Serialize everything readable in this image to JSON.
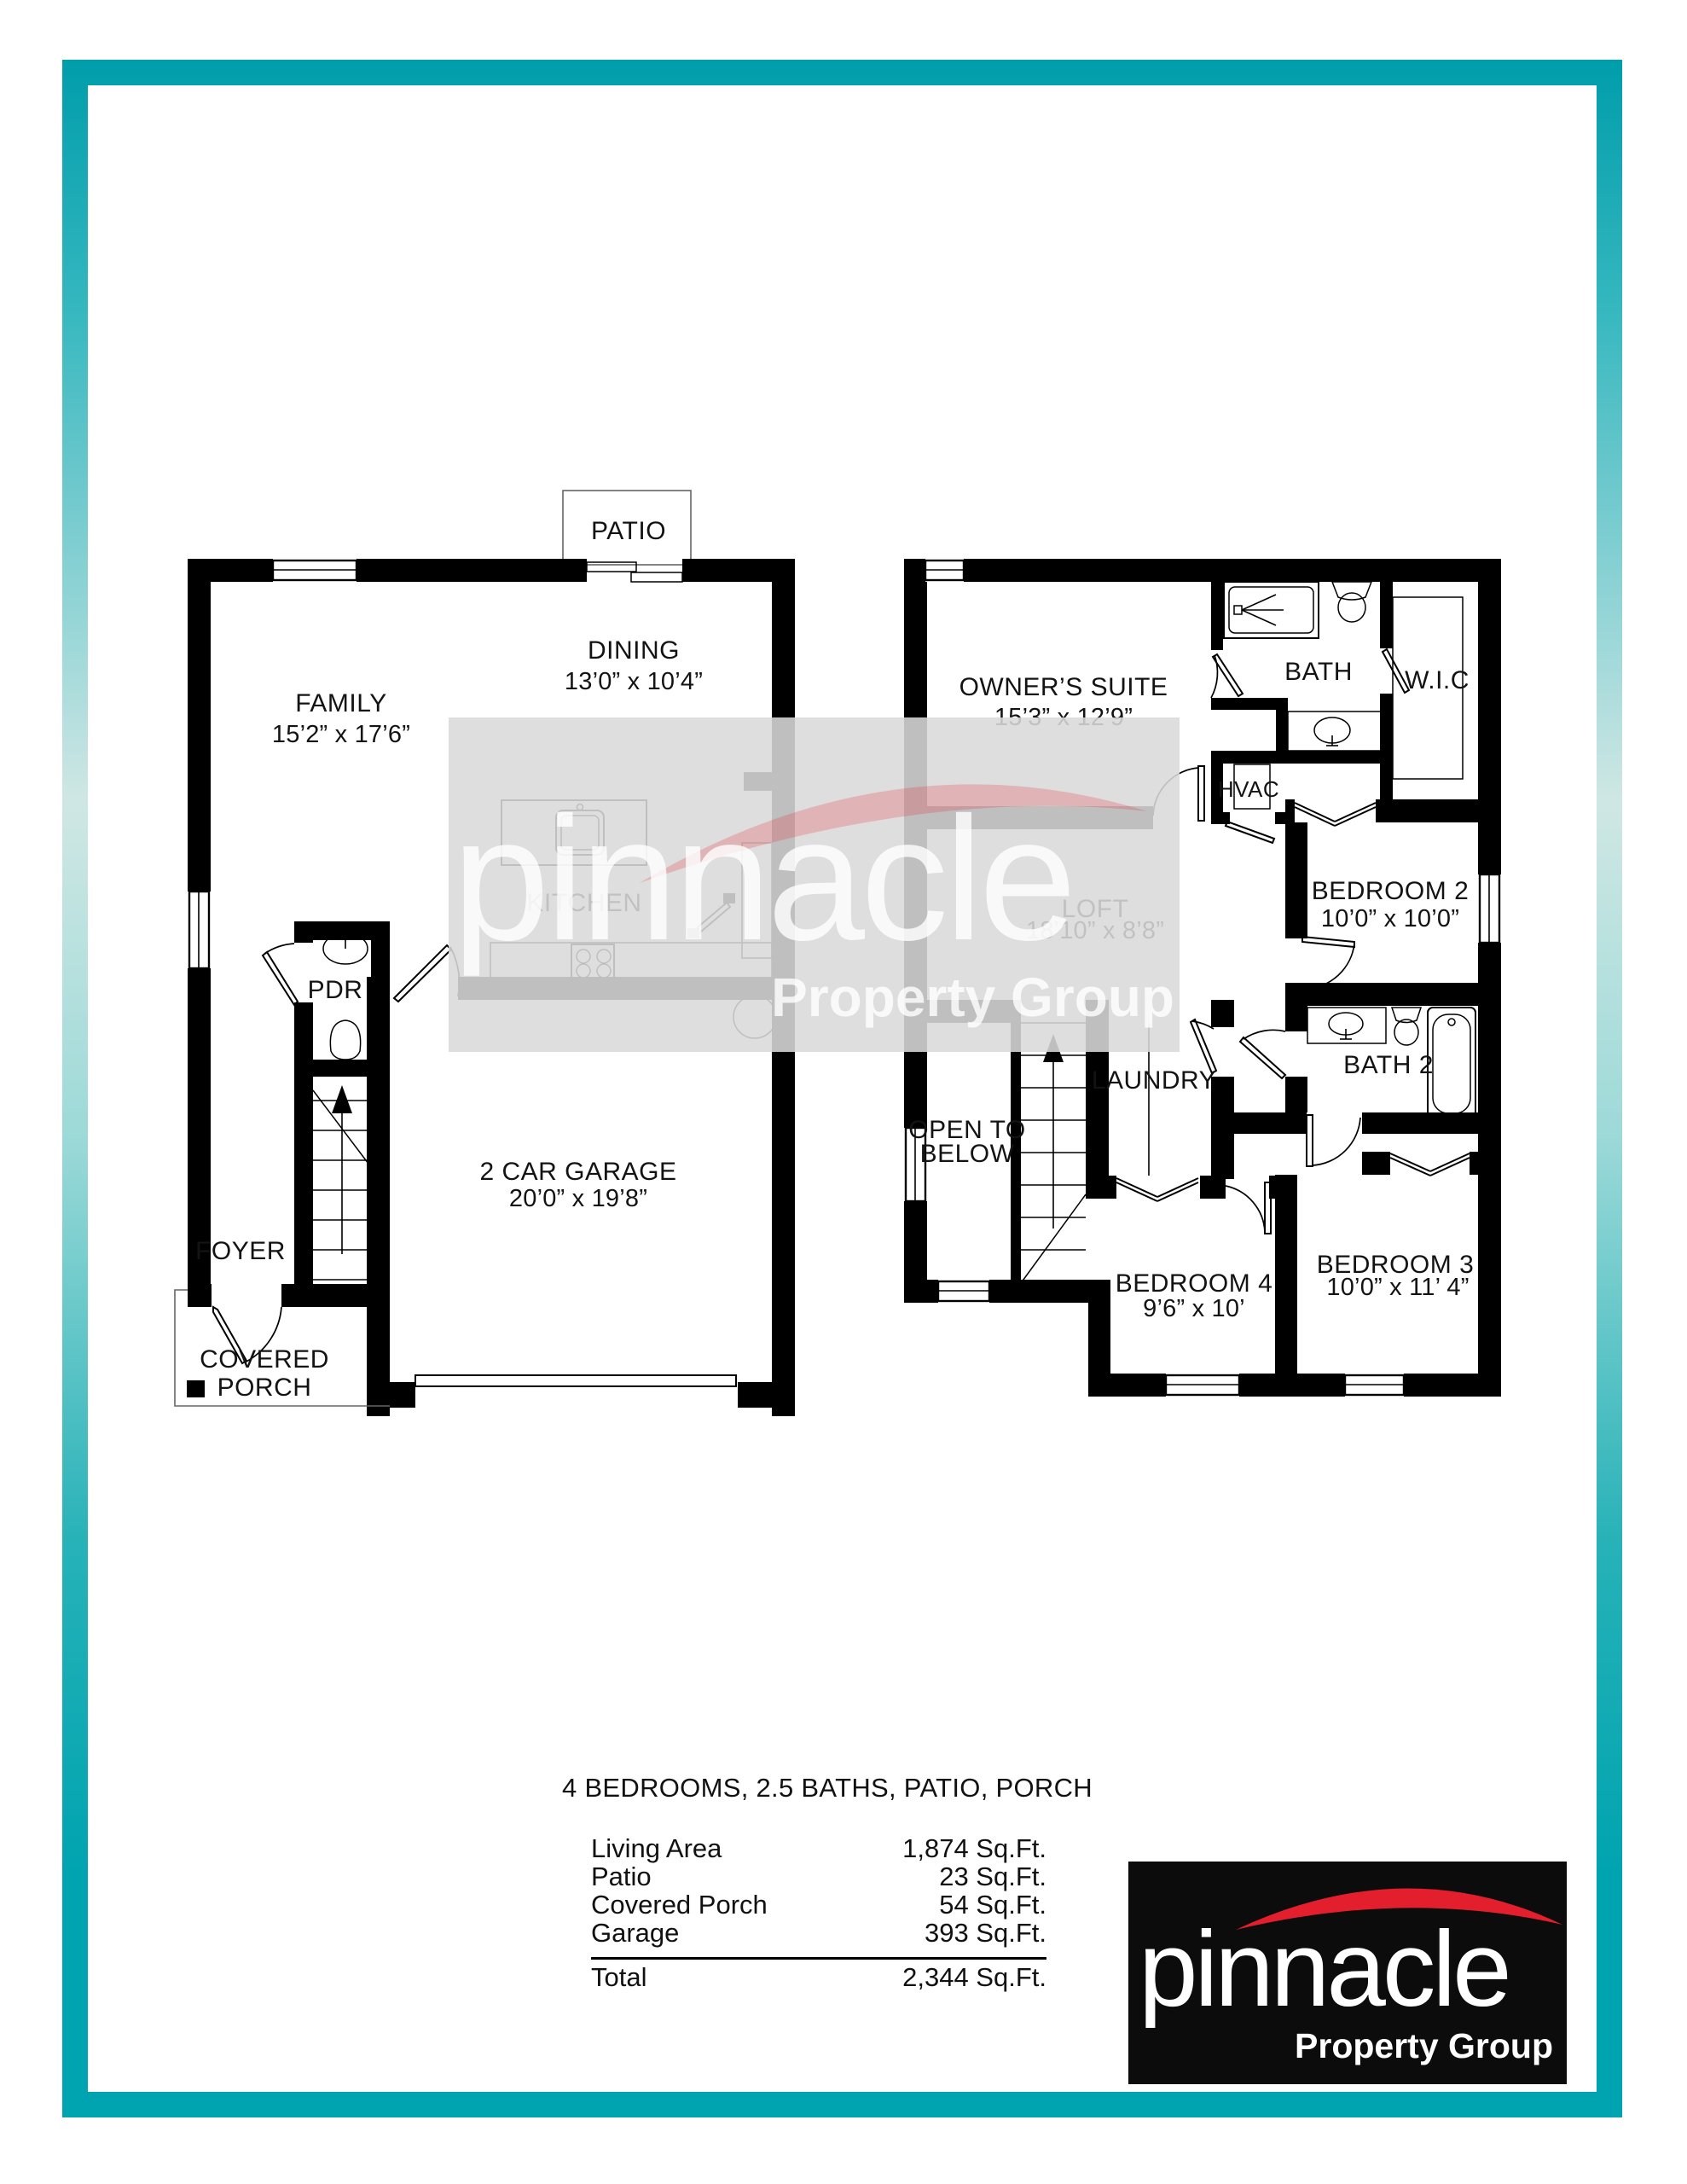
{
  "brand": {
    "name": "pinnacle",
    "tagline": "Property Group"
  },
  "colors": {
    "frame_teal": "#00a4b0",
    "logo_red": "#e31e2d",
    "logo_bg": "#0c0c0c",
    "wall_black": "#000000",
    "watermark_gray": "#d9d9d9"
  },
  "summary": {
    "headline": "4 BEDROOMS, 2.5 BATHS, PATIO, PORCH",
    "rows": [
      {
        "label": "Living Area",
        "value": "1,874 Sq.Ft."
      },
      {
        "label": "Patio",
        "value": "23 Sq.Ft."
      },
      {
        "label": "Covered Porch",
        "value": "54 Sq.Ft."
      },
      {
        "label": "Garage",
        "value": "393 Sq.Ft."
      }
    ],
    "total": {
      "label": "Total",
      "value": "2,344 Sq.Ft."
    }
  },
  "first_floor": {
    "rooms": {
      "patio": {
        "name": "PATIO"
      },
      "dining": {
        "name": "DINING",
        "dims": "13’0” x 10’4”"
      },
      "family": {
        "name": "FAMILY",
        "dims": "15’2” x 17’6”"
      },
      "kitchen": {
        "name": "KITCHEN"
      },
      "pdr": {
        "name": "PDR"
      },
      "foyer": {
        "name": "FOYER"
      },
      "covered_porch": {
        "line1": "COVERED",
        "line2": "PORCH"
      },
      "garage": {
        "name": "2 CAR GARAGE",
        "dims": "20’0” x 19’8”"
      }
    }
  },
  "second_floor": {
    "rooms": {
      "owners_suite": {
        "name": "OWNER’S SUITE",
        "dims": "15’3” x 12’9”"
      },
      "bath": {
        "name": "BATH"
      },
      "wic": {
        "name": "W.I.C"
      },
      "hvac": {
        "name": "HVAC"
      },
      "loft": {
        "name": "LOFT",
        "dims": "18’10” x 8’8”"
      },
      "bedroom2": {
        "name": "BEDROOM 2",
        "dims": "10’0” x 10’0”"
      },
      "laundry": {
        "name": "LAUNDRY"
      },
      "bath2": {
        "name": "BATH 2"
      },
      "open_below": {
        "line1": "OPEN TO",
        "line2": "BELOW"
      },
      "bedroom4": {
        "name": "BEDROOM 4",
        "dims": "9’6” x 10’"
      },
      "bedroom3": {
        "name": "BEDROOM 3",
        "dims": "10’0” x 11’ 4”"
      }
    }
  },
  "watermark": {
    "name": "pinnacle",
    "tagline": "Property Group"
  }
}
